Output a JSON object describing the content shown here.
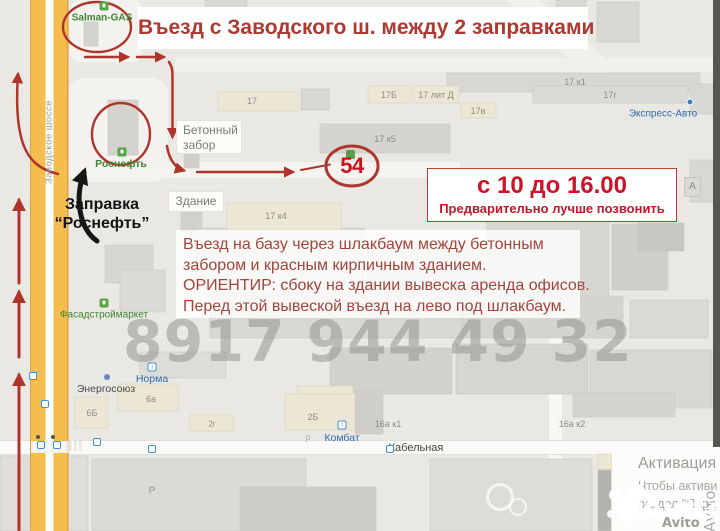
{
  "title": "Въезд с Заводского ш. между 2 заправками",
  "hours": {
    "time": "с 10 до 16.00",
    "note": "Предварительно лучше позвонить"
  },
  "directions": {
    "line1": "Въезд на базу через шлакбаум между бетонным",
    "line2": "забором и красным кирпичным зданием.",
    "line3": "ОРИЕНТИР: сбоку на здании вывеска аренда офисов.",
    "line4": "Перед этой вывеской въезд на лево под шлакбаум."
  },
  "callouts": {
    "gas_station_1": "Salman-GAS",
    "gas_station_2": "Роснефть",
    "pump_label_line1": "Заправка",
    "pump_label_line2": "“Роснефть”",
    "fence_line1": "Бетонный",
    "fence_line2": "забор",
    "building": "Здание",
    "marker_54": "54"
  },
  "map_labels": {
    "road": "Заводское шоссе",
    "street": "Кабельная",
    "b17": "17",
    "b17b": "17Б",
    "b17litd": "17 лит Д",
    "b17v": "17в",
    "b17k1": "17 к1",
    "b17g": "17г",
    "b17k5": "17 к5",
    "b17k4": "17 к4",
    "b6a": "6а",
    "b6b": "6Б",
    "b2g": "2г",
    "b2b": "2Б",
    "b16ak1": "16а к1",
    "b16ak2": "16а к2",
    "b5v2": "5 в2",
    "parking": "Р",
    "parking_small": "р",
    "a_box": "А",
    "express": "Экспресс-Авто",
    "fasad": "Фасадстроймаркет",
    "energo": "Энергосоюз",
    "norma": "Норма",
    "kombat": "Комбат",
    "al": "Ал"
  },
  "watermarks": {
    "phone": "8917 944 49 32",
    "brand": "Avito",
    "brand_small": "Avito",
    "brand_vertical": "Avito"
  },
  "activation": {
    "title": "Активация",
    "line1": "Чтобы активи",
    "line2": "раздел \"Пара"
  },
  "colors": {
    "annotation_red": "#ae352c",
    "bright_red": "#c8152a",
    "poi_green": "#3f8534",
    "poi_blue": "#2e6cb0",
    "road_yellow": "#f5bd4d"
  }
}
